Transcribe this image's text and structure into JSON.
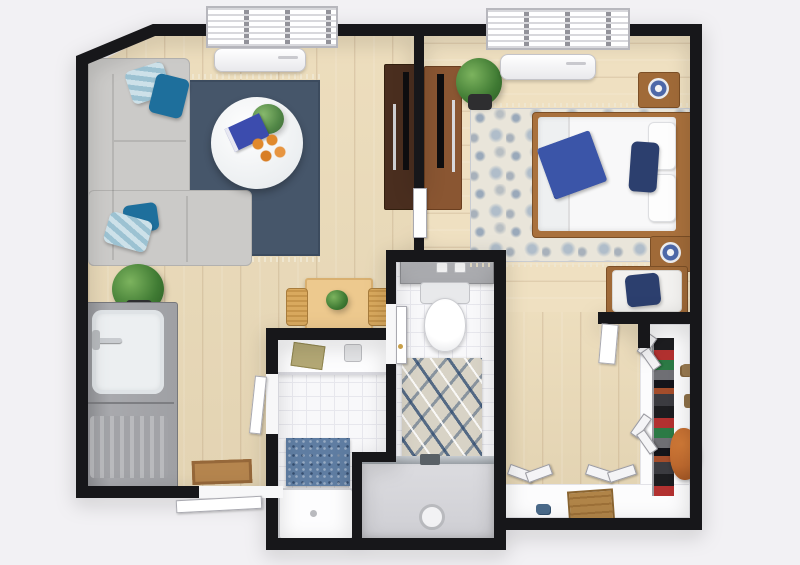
{
  "scene": {
    "title": "3D apartment floor plan, top-down render",
    "background_color": "#f2f1f4",
    "visible_text": "none"
  },
  "palette": {
    "wall": "#17171a",
    "wood_floor": "#ecdcba",
    "living_rug_navy": "#46566a",
    "sofa_gray": "#cbcac8",
    "teal_pillow": "#1e6f9c",
    "navy_pillow": "#2c3f6e",
    "bed_throw_blue": "#3b55a8",
    "furniture_wood": "#a06a38",
    "dark_console": "#4a2e1f",
    "medium_console": "#8a5632",
    "bathroom_tile": "#f8f8fa",
    "mosaic_blue": "#5f7da2",
    "counter_gray": "#9fa0a4",
    "bag_orange": "#bf6a2f",
    "doormat_brown": "#b5854e",
    "plant_green": "#3f7a33"
  },
  "rooms": [
    {
      "name": "living-room",
      "furniture": [
        "window-blinds",
        "ac-unit",
        "gray-sectional-sofa",
        "striped-pillow",
        "teal-pillow",
        "navy-area-rug-with-fringe",
        "round-white-coffee-table",
        "table-plant",
        "blue-book",
        "orange-fruits",
        "floor-plant",
        "dark-tv-console",
        "flat-tv"
      ]
    },
    {
      "name": "kitchen-entry",
      "furniture": [
        "counter-with-sink",
        "chrome-faucet",
        "drainboard",
        "doormat",
        "entry-door",
        "dining-table",
        "wicker-chair-left",
        "wicker-chair-right",
        "table-plant"
      ]
    },
    {
      "name": "bedroom",
      "furniture": [
        "window-blinds",
        "ac-unit",
        "double-bed-white",
        "wood-headboard",
        "white-pillows",
        "navy-pillow",
        "blue-folded-throw",
        "nightstand-top",
        "nightstand-bottom",
        "table-lamp",
        "table-lamp",
        "patterned-blue-rug",
        "medium-tv-console",
        "flat-tv",
        "floor-plant",
        "bench-with-cushion-and-pillow"
      ]
    },
    {
      "name": "bathroom",
      "furniture": [
        "wall-shelf-with-cups",
        "toilet",
        "patterned-bath-rug",
        "walk-in-shower",
        "shower-drain",
        "door-with-brass-handle"
      ]
    },
    {
      "name": "utility-room",
      "furniture": [
        "white-counter",
        "book",
        "cup",
        "blue-mosaic-panel",
        "shower-tray"
      ]
    },
    {
      "name": "walk-in-closet",
      "furniture": [
        "bifold-doors",
        "clothes-rail-with-garments",
        "white-l-shaped-shelf",
        "shoes",
        "orange-leather-bag",
        "wooden-crate",
        "white-door"
      ]
    }
  ]
}
